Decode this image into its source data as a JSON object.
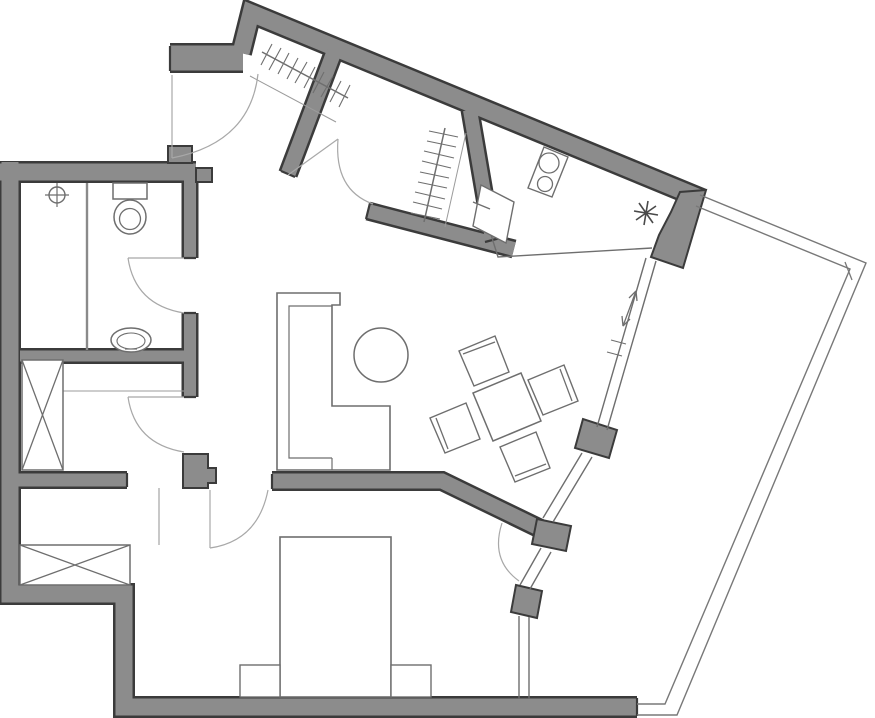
{
  "canvas": {
    "width": 875,
    "height": 718,
    "background": "#ffffff"
  },
  "colors": {
    "wall_fill": "#8c8c8c",
    "wall_stroke": "#3b3b3b",
    "furniture": "#6e6e6e",
    "thin_line": "#a8a8a8",
    "light_line": "#9b9b9b",
    "railing": "#787878",
    "background": "#ffffff"
  },
  "floorplan": {
    "walls": [
      {
        "name": "wall-left-bottom-run",
        "d": "M10 162 V594 H124 V707 H637",
        "w": 17
      },
      {
        "name": "wall-bathroom-top",
        "d": "M0 172 H196",
        "w": 17
      },
      {
        "name": "wall-bathroom-right-upper",
        "d": "M190 177 V258",
        "w": 12
      },
      {
        "name": "wall-bathroom-right-lower",
        "d": "M190 313 V397",
        "w": 12
      },
      {
        "name": "wall-bath-storage-divider",
        "d": "M20 356 H196",
        "w": 11
      },
      {
        "name": "wall-storage-bedroom",
        "d": "M18 480 H127",
        "w": 13
      },
      {
        "name": "wall-entry-stub",
        "d": "M170 58 H243",
        "w": 25
      },
      {
        "name": "wall-top-angled",
        "d": "M241 53 L251 13 L702 199",
        "w": 17
      },
      {
        "name": "wall-entry-closet-divider",
        "d": "M334 52 L288 174",
        "w": 15
      },
      {
        "name": "wall-closet-kitchen",
        "d": "M470 110 L492 239",
        "w": 14
      },
      {
        "name": "wall-closet-bottom",
        "d": "M368 211 L514 249",
        "w": 14
      },
      {
        "name": "wall-living-bedroom-partition",
        "d": "M272 481 H442 L549 533",
        "w": 15
      }
    ],
    "solids": [
      {
        "name": "kitchen-corner-block",
        "points": "706,190 683,268 651,257 659,235 671,212 680,192"
      },
      {
        "name": "glazed-wall-pier-1",
        "points": "617,430 609,458 575,448 583,419"
      },
      {
        "name": "glazed-wall-pier-2",
        "points": "537,519 571,526 566,551 532,544"
      },
      {
        "name": "glazed-wall-pier-3",
        "points": "516,585 542,591 537,618 511,612"
      },
      {
        "name": "bedroom-door-pier",
        "points": "183,454 208,454 208,468 216,468 216,483 208,483 208,488 183,488"
      },
      {
        "name": "bathroom-top-pier",
        "points": "168,146 192,146 192,163 168,163"
      },
      {
        "name": "bathroom-wall-step",
        "points": "196,168 212,168 212,182 196,182"
      }
    ],
    "shapes": [
      {
        "el": "path",
        "name": "wall-end-caps",
        "a": {
          "d": "M170 46 V71 M184 258 H196 M184 313 H196 M184 397 H196 M272 474 V489 M127 473 V487 M281 171 L295 177 M370 203 L366 219 M485 242 L500 238 M637 698 V716",
          "fill": "none",
          "stroke": "#3b3b3b",
          "stroke-width": "2.2"
        }
      },
      {
        "el": "circle",
        "name": "shower-drain-icon",
        "a": {
          "cx": "57",
          "cy": "195",
          "r": "8",
          "fill": "none",
          "stroke": "#6e6e6e",
          "stroke-width": "1.4"
        }
      },
      {
        "el": "path",
        "name": "shower-drain-cross",
        "a": {
          "d": "M45 195 H69 M57 183 V207",
          "fill": "none",
          "stroke": "#6e6e6e",
          "stroke-width": "1.2"
        }
      },
      {
        "el": "path",
        "name": "shower-screen",
        "a": {
          "d": "M87 183 V350",
          "fill": "none",
          "stroke": "#8a8a8a",
          "stroke-width": "2.4"
        }
      },
      {
        "el": "rect",
        "name": "toilet-tank",
        "a": {
          "x": "113",
          "y": "183",
          "width": "34",
          "height": "16",
          "fill": "#ffffff",
          "stroke": "#6e6e6e",
          "stroke-width": "1.5"
        }
      },
      {
        "el": "ellipse",
        "name": "toilet-bowl",
        "a": {
          "cx": "130",
          "cy": "217",
          "rx": "16",
          "ry": "17",
          "fill": "#ffffff",
          "stroke": "#6e6e6e",
          "stroke-width": "1.5"
        }
      },
      {
        "el": "circle",
        "name": "toilet-bowl-inner",
        "a": {
          "cx": "130",
          "cy": "219",
          "r": "10.5",
          "fill": "none",
          "stroke": "#6e6e6e",
          "stroke-width": "1.3"
        }
      },
      {
        "el": "ellipse",
        "name": "bathroom-sink",
        "a": {
          "cx": "131",
          "cy": "340",
          "rx": "20",
          "ry": "12",
          "fill": "#ffffff",
          "stroke": "#6e6e6e",
          "stroke-width": "1.5"
        }
      },
      {
        "el": "ellipse",
        "name": "bathroom-sink-basin",
        "a": {
          "cx": "131",
          "cy": "341",
          "rx": "14",
          "ry": "8",
          "fill": "none",
          "stroke": "#6e6e6e",
          "stroke-width": "1.1"
        }
      },
      {
        "el": "path",
        "name": "bathroom-sink-tap",
        "a": {
          "d": "M125 349 H137",
          "fill": "none",
          "stroke": "#6e6e6e",
          "stroke-width": "1.2"
        }
      },
      {
        "el": "path",
        "name": "storage-shelf-line",
        "a": {
          "d": "M63 391 H184",
          "fill": "none",
          "stroke": "#9b9b9b",
          "stroke-width": "1.1"
        }
      },
      {
        "el": "rect",
        "name": "storage-wardrobe-box",
        "a": {
          "x": "22",
          "y": "360",
          "width": "41",
          "height": "110",
          "fill": "#ffffff",
          "stroke": "#6e6e6e",
          "stroke-width": "1.5"
        }
      },
      {
        "el": "path",
        "name": "storage-wardrobe-cross",
        "a": {
          "d": "M22 360 L63 470 M63 360 L22 470",
          "fill": "none",
          "stroke": "#6e6e6e",
          "stroke-width": "1.3"
        }
      },
      {
        "el": "path",
        "name": "bedroom-niche-line",
        "a": {
          "d": "M159 488 V545",
          "fill": "none",
          "stroke": "#9b9b9b",
          "stroke-width": "1.1"
        }
      },
      {
        "el": "rect",
        "name": "bedroom-wardrobe-box",
        "a": {
          "x": "20",
          "y": "545",
          "width": "110",
          "height": "40",
          "fill": "#ffffff",
          "stroke": "#6e6e6e",
          "stroke-width": "1.5"
        }
      },
      {
        "el": "path",
        "name": "bedroom-wardrobe-cross",
        "a": {
          "d": "M20 545 L130 585 M130 545 L20 585",
          "fill": "none",
          "stroke": "#6e6e6e",
          "stroke-width": "1.3"
        }
      },
      {
        "el": "rect",
        "name": "bed",
        "a": {
          "x": "280",
          "y": "537",
          "width": "111",
          "height": "160",
          "fill": "#ffffff",
          "stroke": "#6e6e6e",
          "stroke-width": "1.6"
        }
      },
      {
        "el": "rect",
        "name": "nightstand-left",
        "a": {
          "x": "240",
          "y": "665",
          "width": "40",
          "height": "32",
          "fill": "#ffffff",
          "stroke": "#6e6e6e",
          "stroke-width": "1.4"
        }
      },
      {
        "el": "rect",
        "name": "nightstand-right",
        "a": {
          "x": "391",
          "y": "665",
          "width": "40",
          "height": "32",
          "fill": "#ffffff",
          "stroke": "#6e6e6e",
          "stroke-width": "1.4"
        }
      },
      {
        "el": "path",
        "name": "sofa-outline",
        "a": {
          "d": "M277 293 H340 V305 H332 V406 H390 V470 H277 Z",
          "fill": "#ffffff",
          "stroke": "#6e6e6e",
          "stroke-width": "1.6"
        }
      },
      {
        "el": "path",
        "name": "sofa-inner-lines",
        "a": {
          "d": "M332 306 H289 V458 H332 M332 458 V470",
          "fill": "none",
          "stroke": "#6e6e6e",
          "stroke-width": "1.2"
        }
      },
      {
        "el": "circle",
        "name": "coffee-table-round",
        "a": {
          "cx": "381",
          "cy": "355",
          "r": "27",
          "fill": "#ffffff",
          "stroke": "#6e6e6e",
          "stroke-width": "1.5"
        }
      },
      {
        "el": "polygon",
        "name": "dining-table",
        "a": {
          "points": "541,421 521,373 473,393 493,441",
          "fill": "#ffffff",
          "stroke": "#6e6e6e",
          "stroke-width": "1.5"
        }
      },
      {
        "el": "polygon",
        "name": "dining-chair-nw",
        "a": {
          "points": "509,372 495,336 459,351 474,386",
          "fill": "#ffffff",
          "stroke": "#6e6e6e",
          "stroke-width": "1.4"
        }
      },
      {
        "el": "path",
        "name": "dining-chair-nw-back",
        "a": {
          "d": "M463 354 L495 342",
          "fill": "none",
          "stroke": "#6e6e6e",
          "stroke-width": "1.3"
        }
      },
      {
        "el": "polygon",
        "name": "dining-chair-e",
        "a": {
          "points": "578,401 564,365 528,380 543,415",
          "fill": "#ffffff",
          "stroke": "#6e6e6e",
          "stroke-width": "1.4"
        }
      },
      {
        "el": "path",
        "name": "dining-chair-e-back",
        "a": {
          "d": "M560 369 L572 401",
          "fill": "none",
          "stroke": "#6e6e6e",
          "stroke-width": "1.3"
        }
      },
      {
        "el": "polygon",
        "name": "dining-chair-w",
        "a": {
          "points": "480,439 466,403 430,418 445,453",
          "fill": "#ffffff",
          "stroke": "#6e6e6e",
          "stroke-width": "1.4"
        }
      },
      {
        "el": "path",
        "name": "dining-chair-w-back",
        "a": {
          "d": "M436 418 L448 449",
          "fill": "none",
          "stroke": "#6e6e6e",
          "stroke-width": "1.3"
        }
      },
      {
        "el": "polygon",
        "name": "dining-chair-s",
        "a": {
          "points": "550,468 536,432 500,447 515,482",
          "fill": "#ffffff",
          "stroke": "#6e6e6e",
          "stroke-width": "1.4"
        }
      },
      {
        "el": "path",
        "name": "dining-chair-s-back",
        "a": {
          "d": "M515 476 L546 464",
          "fill": "none",
          "stroke": "#6e6e6e",
          "stroke-width": "1.3"
        }
      },
      {
        "el": "path",
        "name": "kitchen-counter-edge",
        "a": {
          "d": "M482 206 L498 257 L652 248",
          "fill": "none",
          "stroke": "#6e6e6e",
          "stroke-width": "1.4"
        }
      },
      {
        "el": "polygon",
        "name": "kitchen-sink",
        "a": {
          "points": "514,202 506,243 473,226 481,185",
          "fill": "#ffffff",
          "stroke": "#6e6e6e",
          "stroke-width": "1.4"
        }
      },
      {
        "el": "path",
        "name": "kitchen-sink-tap",
        "a": {
          "d": "M473 202 L490 209",
          "fill": "none",
          "stroke": "#6e6e6e",
          "stroke-width": "1.4"
        }
      },
      {
        "el": "polygon",
        "name": "stove-frame",
        "a": {
          "points": "552,197 568,157 544,147 528,188",
          "fill": "#ffffff",
          "stroke": "#6e6e6e",
          "stroke-width": "1.4"
        }
      },
      {
        "el": "circle",
        "name": "stove-burner-large",
        "a": {
          "cx": "549",
          "cy": "163",
          "r": "10",
          "fill": "none",
          "stroke": "#6e6e6e",
          "stroke-width": "1.3"
        }
      },
      {
        "el": "circle",
        "name": "stove-burner-small",
        "a": {
          "cx": "545",
          "cy": "184",
          "r": "7.5",
          "fill": "none",
          "stroke": "#6e6e6e",
          "stroke-width": "1.3"
        }
      },
      {
        "el": "path",
        "name": "boiler-asterisk-icon",
        "a": {
          "d": "M658 215 L634 211 M653 223 L639 203 M644 225 L648 201 M636 220 L656 206",
          "fill": "none",
          "stroke": "#4a4a4a",
          "stroke-width": "1.6"
        }
      },
      {
        "el": "path",
        "name": "entry-coat-rail",
        "a": {
          "d": "M262 52 L348 98",
          "fill": "none",
          "stroke": "#6e6e6e",
          "stroke-width": "1.5"
        }
      },
      {
        "el": "path",
        "name": "entry-coat-hangers",
        "a": {
          "d": "M261 65 L272 44 M269 70 L281 48 M278 74 L289 53 M287 79 L298 58 M295 83 L307 62 M304 88 L315 67 M313 93 L324 72 M321 97 L333 76 M330 102 L341 81 M339 107 L350 85",
          "fill": "none",
          "stroke": "#6e6e6e",
          "stroke-width": "1.1"
        }
      },
      {
        "el": "path",
        "name": "entry-closet-front-line",
        "a": {
          "d": "M250 76 L336 122",
          "fill": "none",
          "stroke": "#9b9b9b",
          "stroke-width": "1"
        }
      },
      {
        "el": "path",
        "name": "walkin-closet-rail",
        "a": {
          "d": "M445 128 L424 222",
          "fill": "none",
          "stroke": "#6e6e6e",
          "stroke-width": "1.5"
        }
      },
      {
        "el": "path",
        "name": "walkin-closet-hangers",
        "a": {
          "d": "M429 131 L458 137 M427 141 L456 147 M424 151 L454 158 M422 161 L451 168 M420 172 L449 178 M418 182 L447 188 M415 192 L445 199 M413 202 L442 209 M411 213 L440 219",
          "fill": "none",
          "stroke": "#6e6e6e",
          "stroke-width": "1.1"
        }
      },
      {
        "el": "path",
        "name": "walkin-closet-front-line",
        "a": {
          "d": "M466 133 L445 227",
          "fill": "none",
          "stroke": "#9b9b9b",
          "stroke-width": "1"
        }
      },
      {
        "el": "path",
        "name": "window-band-upper",
        "a": {
          "d": "M656 261 L607 430 M646 258 L597 427",
          "fill": "none",
          "stroke": "#6e6e6e",
          "stroke-width": "1.4"
        }
      },
      {
        "el": "path",
        "name": "window-band-upper-ticks",
        "a": {
          "d": "M611 340 L626 344 M607 352 L622 356",
          "fill": "none",
          "stroke": "#6e6e6e",
          "stroke-width": "1.1"
        }
      },
      {
        "el": "path",
        "name": "window-band-middle",
        "a": {
          "d": "M592 457 L553 522 M582 453 L543 518",
          "fill": "none",
          "stroke": "#6e6e6e",
          "stroke-width": "1.4"
        }
      },
      {
        "el": "path",
        "name": "balcony-door-leaf-glazing",
        "a": {
          "d": "M551 552 L530 589 M541 548 L520 585",
          "fill": "none",
          "stroke": "#6e6e6e",
          "stroke-width": "1.4"
        }
      },
      {
        "el": "path",
        "name": "bedroom-window-band",
        "a": {
          "d": "M519 616 V699 M529 617 V699",
          "fill": "none",
          "stroke": "#6e6e6e",
          "stroke-width": "1.4"
        }
      },
      {
        "el": "path",
        "name": "balcony-railing-inner",
        "a": {
          "d": "M696 206 L850 269 L665 704 H637",
          "fill": "none",
          "stroke": "#787878",
          "stroke-width": "1.4"
        }
      },
      {
        "el": "path",
        "name": "balcony-railing-outer",
        "a": {
          "d": "M700 195 L866 263 L677 715 H637",
          "fill": "none",
          "stroke": "#787878",
          "stroke-width": "1.4"
        }
      },
      {
        "el": "path",
        "name": "balcony-railing-joint-tick",
        "a": {
          "d": "M845 262 L852 280",
          "fill": "none",
          "stroke": "#787878",
          "stroke-width": "1.3"
        }
      },
      {
        "el": "path",
        "name": "entry-door-leaf",
        "a": {
          "d": "M172 75 V158",
          "fill": "none",
          "stroke": "#a8a8a8",
          "stroke-width": "1.2"
        }
      },
      {
        "el": "path",
        "name": "entry-door-arc",
        "a": {
          "d": "M258 74 Q250 143 172 158",
          "fill": "none",
          "stroke": "#a8a8a8",
          "stroke-width": "1.2"
        }
      },
      {
        "el": "path",
        "name": "bathroom-door-leaf",
        "a": {
          "d": "M128 258 H184",
          "fill": "none",
          "stroke": "#a8a8a8",
          "stroke-width": "1.2"
        }
      },
      {
        "el": "path",
        "name": "bathroom-door-arc",
        "a": {
          "d": "M128 258 Q135 305 184 313",
          "fill": "none",
          "stroke": "#a8a8a8",
          "stroke-width": "1.2"
        }
      },
      {
        "el": "path",
        "name": "storage-door-leaf",
        "a": {
          "d": "M128 397 H184",
          "fill": "none",
          "stroke": "#a8a8a8",
          "stroke-width": "1.2"
        }
      },
      {
        "el": "path",
        "name": "storage-door-arc",
        "a": {
          "d": "M128 397 Q135 444 184 452",
          "fill": "none",
          "stroke": "#a8a8a8",
          "stroke-width": "1.2"
        }
      },
      {
        "el": "path",
        "name": "bedroom-door-leaf",
        "a": {
          "d": "M210 490 V548",
          "fill": "none",
          "stroke": "#a8a8a8",
          "stroke-width": "1.2"
        }
      },
      {
        "el": "path",
        "name": "bedroom-door-arc",
        "a": {
          "d": "M210 548 Q258 541 268 490",
          "fill": "none",
          "stroke": "#a8a8a8",
          "stroke-width": "1.2"
        }
      },
      {
        "el": "path",
        "name": "closet-door-leaf",
        "a": {
          "d": "M288 175 L338 139",
          "fill": "none",
          "stroke": "#a8a8a8",
          "stroke-width": "1.2"
        }
      },
      {
        "el": "path",
        "name": "closet-door-arc",
        "a": {
          "d": "M338 139 Q334 190 373 204",
          "fill": "none",
          "stroke": "#a8a8a8",
          "stroke-width": "1.2"
        }
      },
      {
        "el": "path",
        "name": "balcony-door-arc",
        "a": {
          "d": "M502 523 Q490 560 519 581",
          "fill": "none",
          "stroke": "#a8a8a8",
          "stroke-width": "1.2"
        }
      },
      {
        "el": "path",
        "name": "sliding-direction-arrow",
        "a": {
          "d": "M636 291 L623 326",
          "fill": "none",
          "stroke": "#6e6e6e",
          "stroke-width": "1.3"
        }
      },
      {
        "el": "path",
        "name": "sliding-arrow-heads",
        "a": {
          "d": "M636 291 L629 298 M636 291 L637 301 M623 326 L630 319 M623 326 L622 316",
          "fill": "none",
          "stroke": "#6e6e6e",
          "stroke-width": "1.3"
        }
      }
    ]
  }
}
